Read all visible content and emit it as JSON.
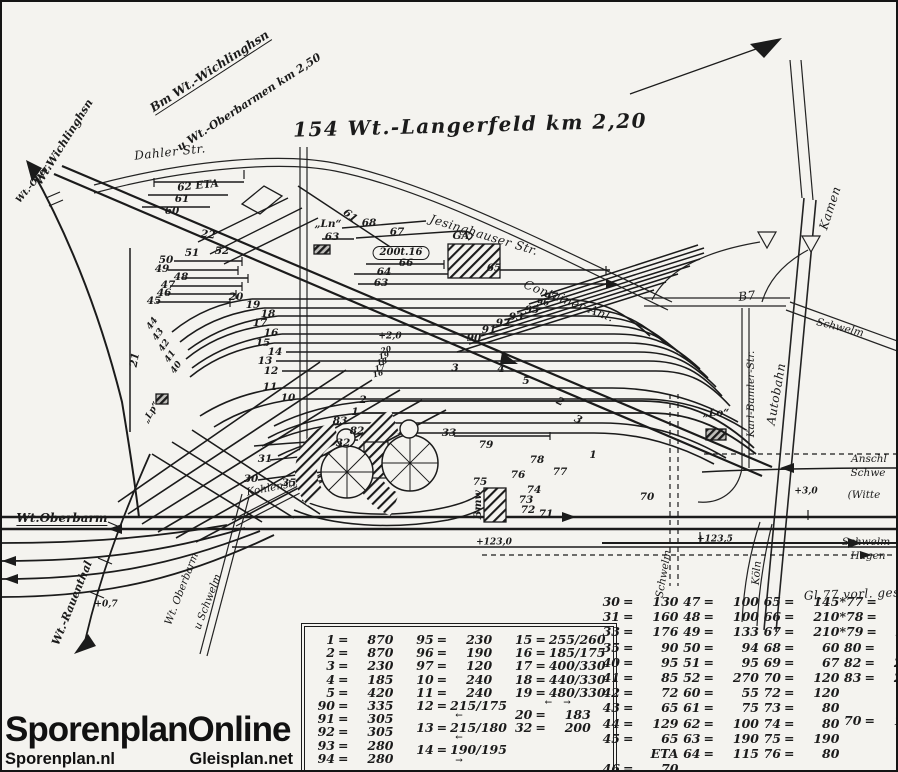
{
  "colors": {
    "ink": "#1b1b1b",
    "paper": "#f4f3ef"
  },
  "branding": {
    "title": "SporenplanOnline",
    "site_left": "Sporenplan.nl",
    "site_right": "Gleisplan.net"
  },
  "diagram": {
    "title": "154 Wt.-Langerfeld km 2,20",
    "labels": [
      {
        "n": "dest-board-line1",
        "t": "Bm Wt.-Wichlinghsn",
        "x": 208,
        "y": 70,
        "r": -33,
        "s": "dest"
      },
      {
        "n": "dest-board-line2",
        "t": "u Wt.-Oberbarmen  km 2,50",
        "x": 247,
        "y": 100,
        "r": -33,
        "s": "dest2"
      },
      {
        "n": "dest-wichlinghausen",
        "t": "Wt.Wichlinghsn",
        "x": 62,
        "y": 140,
        "r": -58,
        "s": "dest2"
      },
      {
        "n": "dest-oberbarmen-stub",
        "t": "Wt.-Ober.",
        "x": 32,
        "y": 182,
        "r": -50,
        "s": "tiny"
      },
      {
        "n": "road-dahler-str",
        "t": "Dahler Str.",
        "x": 168,
        "y": 150,
        "r": -6,
        "s": "road"
      },
      {
        "n": "road-jesinghauser-str",
        "t": "Jesinghauser Str.",
        "x": 482,
        "y": 233,
        "r": 17,
        "s": "road"
      },
      {
        "n": "container-anlage",
        "t": "Container-Anl.",
        "x": 567,
        "y": 299,
        "r": 21,
        "s": "road"
      },
      {
        "n": "road-kamen",
        "t": "Kamen",
        "x": 828,
        "y": 206,
        "r": -72,
        "s": "road"
      },
      {
        "n": "road-b7",
        "t": "B7",
        "x": 745,
        "y": 294,
        "r": -6,
        "s": "road"
      },
      {
        "n": "road-schwelm-ne",
        "t": "Schwelm",
        "x": 838,
        "y": 326,
        "r": 14,
        "s": "roadsm"
      },
      {
        "n": "road-karl-bamler-str",
        "t": "Karl-Bamler-Str.",
        "x": 749,
        "y": 392,
        "r": -90,
        "s": "roadsm"
      },
      {
        "n": "road-autobahn",
        "t": "Autobahn",
        "x": 774,
        "y": 392,
        "r": -80,
        "s": "road"
      },
      {
        "n": "lo-marker-label",
        "t": "„Lo“",
        "x": 714,
        "y": 411,
        "r": 0,
        "s": "num"
      },
      {
        "n": "ln-marker-label",
        "t": "„Ln“",
        "x": 326,
        "y": 222,
        "r": 0,
        "s": "num"
      },
      {
        "n": "ga-building-label",
        "t": "GA",
        "x": 459,
        "y": 234,
        "r": 0,
        "s": "num"
      },
      {
        "n": "crane-note",
        "t": "200t.16",
        "x": 399,
        "y": 251,
        "r": 0,
        "s": "boxed"
      },
      {
        "n": "track-62",
        "t": "62  ETA",
        "x": 196,
        "y": 184,
        "r": -6,
        "s": "num"
      },
      {
        "n": "track-61a",
        "t": "61",
        "x": 180,
        "y": 197,
        "r": 0,
        "s": "num"
      },
      {
        "n": "track-60",
        "t": "60",
        "x": 170,
        "y": 209,
        "r": 0,
        "s": "num"
      },
      {
        "n": "track-61b",
        "t": "61",
        "x": 348,
        "y": 214,
        "r": 38,
        "s": "num"
      },
      {
        "n": "track-22",
        "t": "22",
        "x": 206,
        "y": 233,
        "r": 8,
        "s": "num"
      },
      {
        "n": "track-51",
        "t": "51",
        "x": 190,
        "y": 251,
        "r": 0,
        "s": "num"
      },
      {
        "n": "track-52",
        "t": "52",
        "x": 220,
        "y": 249,
        "r": 0,
        "s": "num"
      },
      {
        "n": "track-50",
        "t": "50",
        "x": 164,
        "y": 258,
        "r": 0,
        "s": "num"
      },
      {
        "n": "track-49",
        "t": "49",
        "x": 160,
        "y": 267,
        "r": 0,
        "s": "num"
      },
      {
        "n": "track-48",
        "t": "48",
        "x": 179,
        "y": 275,
        "r": 0,
        "s": "num"
      },
      {
        "n": "track-47",
        "t": "47",
        "x": 166,
        "y": 283,
        "r": 0,
        "s": "num"
      },
      {
        "n": "track-46",
        "t": "46",
        "x": 162,
        "y": 291,
        "r": 0,
        "s": "num"
      },
      {
        "n": "track-45",
        "t": "45",
        "x": 152,
        "y": 299,
        "r": 0,
        "s": "num"
      },
      {
        "n": "track-20",
        "t": "20",
        "x": 234,
        "y": 295,
        "r": 0,
        "s": "num"
      },
      {
        "n": "track-19",
        "t": "19",
        "x": 251,
        "y": 303,
        "r": 0,
        "s": "num"
      },
      {
        "n": "track-18",
        "t": "18",
        "x": 266,
        "y": 312,
        "r": 0,
        "s": "num"
      },
      {
        "n": "track-17",
        "t": "17",
        "x": 258,
        "y": 321,
        "r": 0,
        "s": "num"
      },
      {
        "n": "track-16",
        "t": "16",
        "x": 269,
        "y": 331,
        "r": 0,
        "s": "num"
      },
      {
        "n": "track-15",
        "t": "15",
        "x": 261,
        "y": 341,
        "r": 0,
        "s": "num"
      },
      {
        "n": "track-14",
        "t": "14",
        "x": 273,
        "y": 350,
        "r": 0,
        "s": "num"
      },
      {
        "n": "track-13",
        "t": "13",
        "x": 263,
        "y": 359,
        "r": 0,
        "s": "num"
      },
      {
        "n": "track-12",
        "t": "12",
        "x": 269,
        "y": 369,
        "r": 0,
        "s": "num"
      },
      {
        "n": "track-11",
        "t": "11",
        "x": 268,
        "y": 385,
        "r": 0,
        "s": "num"
      },
      {
        "n": "track-10",
        "t": "10",
        "x": 286,
        "y": 396,
        "r": 0,
        "s": "num"
      },
      {
        "n": "track-21",
        "t": "21",
        "x": 133,
        "y": 358,
        "r": -80,
        "s": "num"
      },
      {
        "n": "km-mark-2-0",
        "t": "+2,0",
        "x": 388,
        "y": 335,
        "r": 0,
        "s": "tiny"
      },
      {
        "n": "mid-track-20",
        "t": "20",
        "x": 384,
        "y": 348,
        "r": -15,
        "s": "tiny6"
      },
      {
        "n": "mid-track-19",
        "t": "19",
        "x": 382,
        "y": 354,
        "r": -15,
        "s": "tiny6"
      },
      {
        "n": "mid-track-18",
        "t": "18",
        "x": 380,
        "y": 360,
        "r": -15,
        "s": "tiny6"
      },
      {
        "n": "mid-track-17",
        "t": "17",
        "x": 378,
        "y": 366,
        "r": -15,
        "s": "tiny6"
      },
      {
        "n": "mid-track-16",
        "t": "16",
        "x": 376,
        "y": 372,
        "r": -15,
        "s": "tiny6"
      },
      {
        "n": "track-3",
        "t": "3",
        "x": 453,
        "y": 366,
        "r": 0,
        "s": "num"
      },
      {
        "n": "track-4",
        "t": "4",
        "x": 499,
        "y": 367,
        "r": 0,
        "s": "num"
      },
      {
        "n": "track-5",
        "t": "5",
        "x": 524,
        "y": 379,
        "r": 0,
        "s": "num"
      },
      {
        "n": "track-2a",
        "t": "2",
        "x": 361,
        "y": 398,
        "r": 0,
        "s": "num"
      },
      {
        "n": "track-1a",
        "t": "1",
        "x": 353,
        "y": 410,
        "r": 0,
        "s": "num"
      },
      {
        "n": "track-83",
        "t": "83",
        "x": 338,
        "y": 419,
        "r": 0,
        "s": "num"
      },
      {
        "n": "track-82",
        "t": "82",
        "x": 355,
        "y": 429,
        "r": 0,
        "s": "num"
      },
      {
        "n": "track-2b",
        "t": "2",
        "x": 558,
        "y": 400,
        "r": 26,
        "s": "num"
      },
      {
        "n": "track-3b",
        "t": "3",
        "x": 576,
        "y": 418,
        "r": 26,
        "s": "num"
      },
      {
        "n": "track-90",
        "t": "90",
        "x": 472,
        "y": 336,
        "r": 0,
        "s": "num"
      },
      {
        "n": "track-91",
        "t": "91",
        "x": 487,
        "y": 328,
        "r": 0,
        "s": "num"
      },
      {
        "n": "track-92",
        "t": "92",
        "x": 501,
        "y": 321,
        "r": 0,
        "s": "num"
      },
      {
        "n": "track-93",
        "t": "93",
        "x": 514,
        "y": 315,
        "r": 0,
        "s": "num"
      },
      {
        "n": "track-95",
        "t": "95",
        "x": 530,
        "y": 308,
        "r": 0,
        "s": "num"
      },
      {
        "n": "track-96",
        "t": "96",
        "x": 541,
        "y": 302,
        "r": 0,
        "s": "tiny"
      },
      {
        "n": "track-97",
        "t": "97",
        "x": 549,
        "y": 295,
        "r": 0,
        "s": "num"
      },
      {
        "n": "track-63a",
        "t": "63",
        "x": 330,
        "y": 235,
        "r": 0,
        "s": "num"
      },
      {
        "n": "track-68",
        "t": "68",
        "x": 367,
        "y": 221,
        "r": 0,
        "s": "num"
      },
      {
        "n": "track-67",
        "t": "67",
        "x": 395,
        "y": 230,
        "r": 0,
        "s": "num"
      },
      {
        "n": "track-66",
        "t": "66",
        "x": 404,
        "y": 261,
        "r": 0,
        "s": "num"
      },
      {
        "n": "track-64",
        "t": "64",
        "x": 382,
        "y": 270,
        "r": 0,
        "s": "num"
      },
      {
        "n": "track-63b",
        "t": "63",
        "x": 379,
        "y": 281,
        "r": 0,
        "s": "num"
      },
      {
        "n": "track-65",
        "t": "65",
        "x": 492,
        "y": 266,
        "r": 0,
        "s": "num"
      },
      {
        "n": "track-32",
        "t": "32",
        "x": 341,
        "y": 441,
        "r": 0,
        "s": "num"
      },
      {
        "n": "track-33",
        "t": "33",
        "x": 447,
        "y": 431,
        "r": 0,
        "s": "num"
      },
      {
        "n": "track-31",
        "t": "31",
        "x": 263,
        "y": 457,
        "r": 0,
        "s": "num"
      },
      {
        "n": "track-30",
        "t": "30",
        "x": 249,
        "y": 477,
        "r": 0,
        "s": "num"
      },
      {
        "n": "track-35",
        "t": "35",
        "x": 287,
        "y": 481,
        "r": 0,
        "s": "num"
      },
      {
        "n": "road-kohlenstr",
        "t": "Kohlenstr",
        "x": 270,
        "y": 486,
        "r": -11,
        "s": "roadsm"
      },
      {
        "n": "track-79",
        "t": "79",
        "x": 484,
        "y": 443,
        "r": 0,
        "s": "num"
      },
      {
        "n": "track-78",
        "t": "78",
        "x": 535,
        "y": 458,
        "r": 0,
        "s": "num"
      },
      {
        "n": "track-77",
        "t": "77",
        "x": 558,
        "y": 470,
        "r": 0,
        "s": "num"
      },
      {
        "n": "track-76",
        "t": "76",
        "x": 516,
        "y": 473,
        "r": 0,
        "s": "num"
      },
      {
        "n": "track-75",
        "t": "75",
        "x": 478,
        "y": 480,
        "r": 0,
        "s": "num"
      },
      {
        "n": "track-74",
        "t": "74",
        "x": 532,
        "y": 488,
        "r": 0,
        "s": "num"
      },
      {
        "n": "track-73",
        "t": "73",
        "x": 524,
        "y": 498,
        "r": 0,
        "s": "num"
      },
      {
        "n": "track-72",
        "t": "72",
        "x": 526,
        "y": 508,
        "r": 0,
        "s": "num"
      },
      {
        "n": "track-71",
        "t": "71",
        "x": 544,
        "y": 512,
        "r": 0,
        "s": "num"
      },
      {
        "n": "track-70",
        "t": "70",
        "x": 645,
        "y": 495,
        "r": 0,
        "s": "num"
      },
      {
        "n": "track-1b",
        "t": "1",
        "x": 591,
        "y": 453,
        "r": 0,
        "s": "num"
      },
      {
        "n": "bmw-building-label",
        "t": "Bmw",
        "x": 476,
        "y": 503,
        "r": -90,
        "s": "num"
      },
      {
        "n": "km-mark-123-0",
        "t": "+123,0",
        "x": 492,
        "y": 541,
        "r": 0,
        "s": "tiny"
      },
      {
        "n": "km-mark-123-5",
        "t": "+123,5",
        "x": 713,
        "y": 538,
        "r": 0,
        "s": "tiny"
      },
      {
        "n": "km-mark-3-0",
        "t": "+3,0",
        "x": 804,
        "y": 490,
        "r": 0,
        "s": "tiny"
      },
      {
        "n": "anschluss-line1",
        "t": "Anschl",
        "x": 867,
        "y": 457,
        "r": 0,
        "s": "roadsm"
      },
      {
        "n": "anschluss-line2",
        "t": "Schwe",
        "x": 866,
        "y": 471,
        "r": 0,
        "s": "roadsm"
      },
      {
        "n": "witte-label",
        "t": "(Witte",
        "x": 862,
        "y": 493,
        "r": 0,
        "s": "roadsm"
      },
      {
        "n": "direction-schwelm",
        "t": "Schwelm",
        "x": 864,
        "y": 540,
        "r": 0,
        "s": "roadsm"
      },
      {
        "n": "direction-hagen",
        "t": "Hagen",
        "x": 866,
        "y": 554,
        "r": 0,
        "s": "roadsm"
      },
      {
        "n": "note-gl77",
        "t": "Gl.77 vorl. ges.",
        "x": 852,
        "y": 592,
        "r": -2,
        "s": "road"
      },
      {
        "n": "boundary-schwelm",
        "t": "Schwelm",
        "x": 662,
        "y": 572,
        "r": -80,
        "s": "roadsm"
      },
      {
        "n": "direction-koeln",
        "t": "Köln",
        "x": 755,
        "y": 571,
        "r": -85,
        "s": "roadsm"
      },
      {
        "n": "dest-oberbarm",
        "t": "Wt.Oberbarm",
        "x": 60,
        "y": 517,
        "r": 0,
        "s": "dest"
      },
      {
        "n": "dest-rauenthal",
        "t": "Wt.-Rauenthal",
        "x": 70,
        "y": 601,
        "r": -68,
        "s": "dest2"
      },
      {
        "n": "road-oberbarm",
        "t": "Wt. Oberbarm",
        "x": 180,
        "y": 587,
        "r": -69,
        "s": "roadsm"
      },
      {
        "n": "road-u-schwelm",
        "t": "u Schwelm",
        "x": 206,
        "y": 600,
        "r": -69,
        "s": "roadsm"
      },
      {
        "n": "km-mark-0-7",
        "t": "+0,7",
        "x": 104,
        "y": 603,
        "r": 0,
        "s": "tiny"
      },
      {
        "n": "track-44",
        "t": "44",
        "x": 151,
        "y": 322,
        "r": -55,
        "s": "tiny"
      },
      {
        "n": "track-43",
        "t": "43",
        "x": 157,
        "y": 333,
        "r": -55,
        "s": "tiny"
      },
      {
        "n": "track-42",
        "t": "42",
        "x": 163,
        "y": 344,
        "r": -55,
        "s": "tiny"
      },
      {
        "n": "track-41",
        "t": "41",
        "x": 169,
        "y": 355,
        "r": -55,
        "s": "tiny"
      },
      {
        "n": "track-40",
        "t": "40",
        "x": 175,
        "y": 366,
        "r": -55,
        "s": "tiny"
      },
      {
        "n": "lp-marker-label",
        "t": "„Lp“",
        "x": 150,
        "y": 411,
        "r": -60,
        "s": "tiny"
      }
    ]
  },
  "tables": {
    "left": [
      [
        {
          "k": "1",
          "v": "870"
        },
        {
          "k": "2",
          "v": "870"
        },
        {
          "k": "3",
          "v": "230"
        },
        {
          "k": "4",
          "v": "185"
        },
        {
          "k": "5",
          "v": "420"
        },
        {
          "k": "90",
          "v": "335"
        },
        {
          "k": "91",
          "v": "305"
        },
        {
          "k": "92",
          "v": "305"
        },
        {
          "k": "93",
          "v": "280"
        },
        {
          "k": "94",
          "v": "280"
        }
      ],
      [
        {
          "k": "95",
          "v": "230"
        },
        {
          "k": "96",
          "v": "190"
        },
        {
          "k": "97",
          "v": "120"
        },
        {
          "k": "10",
          "v": "240"
        },
        {
          "k": "11",
          "v": "240"
        },
        {
          "k": "12",
          "v": "215/175",
          "note": "←"
        },
        {
          "k": "13",
          "v": "215/180",
          "note": "←"
        },
        {
          "k": "14",
          "v": "190/195",
          "note": "→"
        }
      ],
      [
        {
          "k": "15",
          "v": "255/260"
        },
        {
          "k": "16",
          "v": "185/175"
        },
        {
          "k": "17",
          "v": "400/330"
        },
        {
          "k": "18",
          "v": "440/330"
        },
        {
          "k": "19",
          "v": "480/330",
          "note": "← →"
        },
        {
          "k": "20",
          "v": "183"
        },
        {
          "k": "32",
          "v": "200"
        }
      ]
    ],
    "right": [
      [
        {
          "k": "30",
          "v": "130"
        },
        {
          "k": "31",
          "v": "160"
        },
        {
          "k": "33",
          "v": "176"
        },
        {
          "k": "35",
          "v": "90"
        },
        {
          "k": "40",
          "v": "95"
        },
        {
          "k": "41",
          "v": "85"
        },
        {
          "k": "42",
          "v": "72"
        },
        {
          "k": "43",
          "v": "65"
        },
        {
          "k": "44",
          "v": "129"
        },
        {
          "k": "45",
          "v": "65 ETA"
        },
        {
          "k": "46",
          "v": "70"
        }
      ],
      [
        {
          "k": "47",
          "v": "100"
        },
        {
          "k": "48",
          "v": "100"
        },
        {
          "k": "49",
          "v": "133"
        },
        {
          "k": "50",
          "v": "94"
        },
        {
          "k": "51",
          "v": "95"
        },
        {
          "k": "52",
          "v": "270"
        },
        {
          "k": "60",
          "v": "55"
        },
        {
          "k": "61",
          "v": "75"
        },
        {
          "k": "62",
          "v": "100"
        },
        {
          "k": "63",
          "v": "190"
        },
        {
          "k": "64",
          "v": "115"
        }
      ],
      [
        {
          "k": "65",
          "v": "145"
        },
        {
          "k": "66",
          "v": "210"
        },
        {
          "k": "67",
          "v": "210"
        },
        {
          "k": "68",
          "v": "60"
        },
        {
          "k": "69",
          "v": "67"
        },
        {
          "k": "70",
          "v": "120"
        },
        {
          "k": "72",
          "v": "120"
        },
        {
          "k": "73",
          "v": "80"
        },
        {
          "k": "74",
          "v": "80"
        },
        {
          "k": "75",
          "v": "190"
        },
        {
          "k": "76",
          "v": "80"
        }
      ],
      [
        {
          "k": "*77",
          "v": "150"
        },
        {
          "k": "*78",
          "v": "160"
        },
        {
          "k": "*79",
          "v": "285"
        },
        {
          "k": "80",
          "v": "85"
        },
        {
          "k": "82",
          "v": "263"
        },
        {
          "k": "83",
          "v": "252"
        },
        {
          "k": "70",
          "v": "175",
          "gap": true
        }
      ]
    ]
  }
}
